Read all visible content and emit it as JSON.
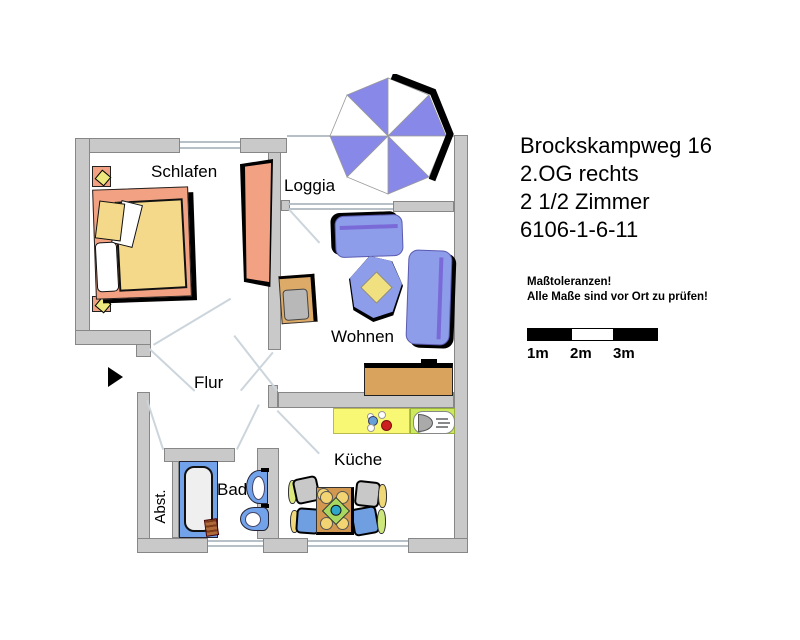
{
  "header": {
    "address": "Brockskampweg 16",
    "floor": "2.OG rechts",
    "rooms_count": "2 1/2 Zimmer",
    "plan_id": "6106-1-6-11"
  },
  "notice": {
    "title": "Maßtoleranzen!",
    "body": "Alle Maße sind vor Ort zu prüfen!"
  },
  "scale": {
    "labels": [
      "1m",
      "2m",
      "3m"
    ]
  },
  "rooms": {
    "schlafen": "Schlafen",
    "loggia": "Loggia",
    "wohnen": "Wohnen",
    "flur": "Flur",
    "kueche": "Küche",
    "bad": "Bad",
    "abst": "Abst."
  },
  "colors": {
    "wall_gray": "#c9c9c9",
    "furniture_blue": "#8d9dea",
    "accent_purple": "#7a6ad8",
    "bath_blue": "#72a2ea",
    "salmon": "#f2a183",
    "duvet_yellow": "#f5d98b",
    "lamp_yellow": "#ece87e",
    "kitchen_yellow": "#f8f874",
    "sink_green": "#cdea5e",
    "stove_red": "#cc1f1f",
    "burner_blue": "#66a0d8",
    "wood_brown": "#d9a35e",
    "umbrella_blue": "#8888e8"
  }
}
